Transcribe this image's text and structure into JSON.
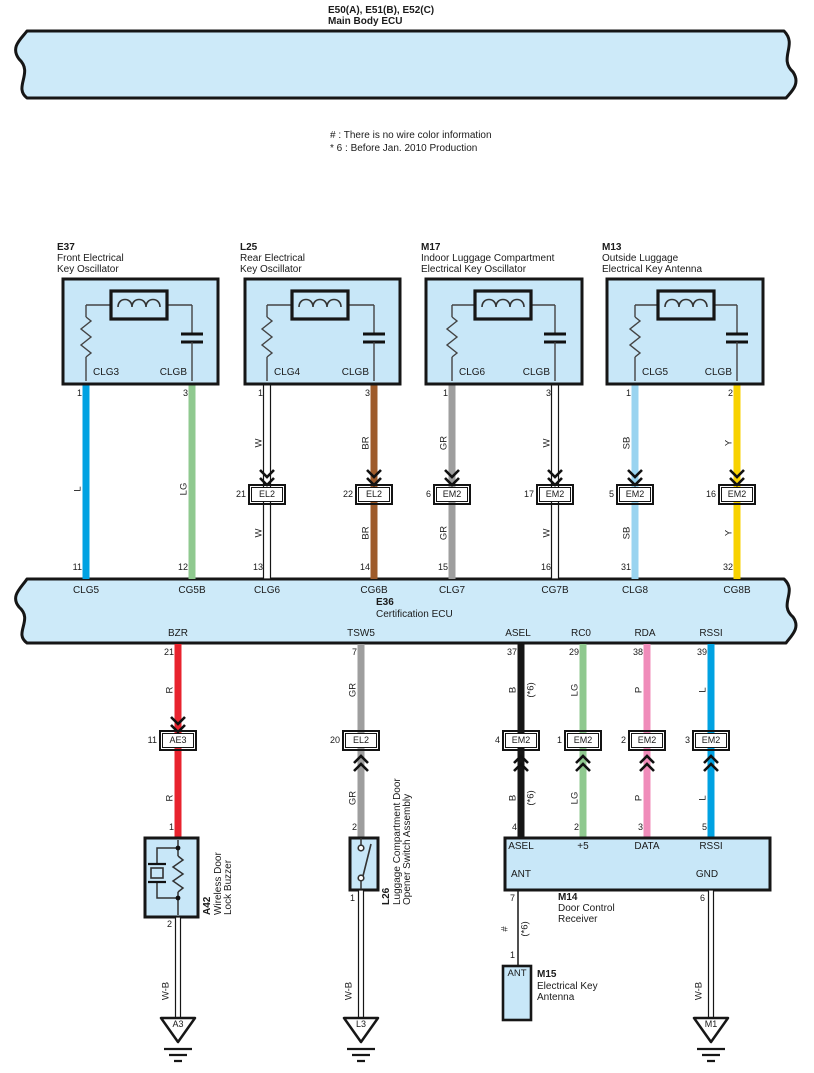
{
  "colors": {
    "band": "#cdeaf9",
    "box": "#c8e7f8",
    "outline": "#161616",
    "L": "#00a2e2",
    "LG": "#8fc98f",
    "BR": "#9e5b2b",
    "GR": "#9e9e9e",
    "SB": "#9ad4f0",
    "Y": "#f8d200",
    "R": "#e8232e",
    "B": "#161616",
    "P": "#f08cba",
    "W": "#ffffff"
  },
  "header": {
    "code": "E50(A), E51(B), E52(C)",
    "name": "Main Body ECU"
  },
  "notes": {
    "n1": "# : There is no wire color information",
    "n2": "* 6 : Before Jan.  2010 Production"
  },
  "osc": [
    {
      "id": "E37",
      "n1": "Front Electrical",
      "n2": "Key Oscillator",
      "lpad": "CLG3",
      "rpad": "CLGB",
      "lpin": "1",
      "rpin": "3",
      "lwire": "L",
      "rwire": "LG"
    },
    {
      "id": "L25",
      "n1": "Rear Electrical",
      "n2": "Key Oscillator",
      "lpad": "CLG4",
      "rpad": "CLGB",
      "lpin": "1",
      "rpin": "3",
      "lwire": "W",
      "rwire": "BR",
      "lcpin": "21",
      "lconn": "EL2",
      "rcpin": "22",
      "rconn": "EL2"
    },
    {
      "id": "M17",
      "n1": "Indoor Luggage Compartment",
      "n2": "Electrical Key Oscillator",
      "lpad": "CLG6",
      "rpad": "CLGB",
      "lpin": "1",
      "rpin": "3",
      "lwire": "GR",
      "rwire": "W",
      "lcpin": "6",
      "lconn": "EM2",
      "rcpin": "17",
      "rconn": "EM2"
    },
    {
      "id": "M13",
      "n1": "Outside Luggage",
      "n2": "Electrical Key Antenna",
      "lpad": "CLG5",
      "rpad": "CLGB",
      "lpin": "1",
      "rpin": "2",
      "lwire": "SB",
      "rwire": "Y",
      "lcpin": "5",
      "lconn": "EM2",
      "rcpin": "16",
      "rconn": "EM2"
    }
  ],
  "ecu": {
    "id": "E36",
    "name": "Certification ECU",
    "tp": [
      {
        "no": "11",
        "pad": "CLG5"
      },
      {
        "no": "12",
        "pad": "CG5B"
      },
      {
        "no": "13",
        "pad": "CLG6"
      },
      {
        "no": "14",
        "pad": "CG6B"
      },
      {
        "no": "15",
        "pad": "CLG7"
      },
      {
        "no": "16",
        "pad": "CG7B"
      },
      {
        "no": "31",
        "pad": "CLG8"
      },
      {
        "no": "32",
        "pad": "CG8B"
      }
    ],
    "bp": [
      {
        "sig": "BZR",
        "no": "21"
      },
      {
        "sig": "TSW5",
        "no": "7"
      },
      {
        "sig": "ASEL",
        "no": "37"
      },
      {
        "sig": "RC0",
        "no": "29"
      },
      {
        "sig": "RDA",
        "no": "38"
      },
      {
        "sig": "RSSI",
        "no": "39"
      }
    ]
  },
  "lw": [
    {
      "wire": "R",
      "cpin": "11",
      "conn": "AE3",
      "dpin": "1"
    },
    {
      "wire": "GR",
      "cpin": "20",
      "conn": "EL2",
      "dpin": "2"
    },
    {
      "wire": "B",
      "star": "(*6)",
      "cpin": "4",
      "conn": "EM2",
      "dpin": "4"
    },
    {
      "wire": "LG",
      "cpin": "1",
      "conn": "EM2",
      "dpin": "2"
    },
    {
      "wire": "P",
      "cpin": "2",
      "conn": "EM2",
      "dpin": "3"
    },
    {
      "wire": "L",
      "cpin": "3",
      "conn": "EM2",
      "dpin": "5"
    }
  ],
  "buzzer": {
    "id": "A42",
    "n1": "Wireless Door",
    "n2": "Lock Buzzer",
    "tpin": "1",
    "bpin": "2",
    "gwire": "W-B",
    "gid": "A3"
  },
  "lugswitch": {
    "id": "L26",
    "n1": "Luggage Compartment Door",
    "n2": "Opener Switch Assembly",
    "tpin": "2",
    "bpin": "1",
    "gwire": "W-B",
    "gid": "L3"
  },
  "receiver": {
    "id": "M14",
    "n1": "Door Control",
    "n2": "Receiver",
    "pads": [
      "ASEL",
      "+5",
      "DATA",
      "RSSI"
    ],
    "ant": "ANT",
    "gnd": "GND",
    "antpin": "7",
    "gndpin": "6",
    "hash": "#",
    "star": "(*6)",
    "antdpin": "1",
    "gwire": "W-B",
    "gid": "M1"
  },
  "antenna": {
    "id": "M15",
    "n1": "Electrical Key",
    "n2": "Antenna",
    "pad": "ANT"
  }
}
